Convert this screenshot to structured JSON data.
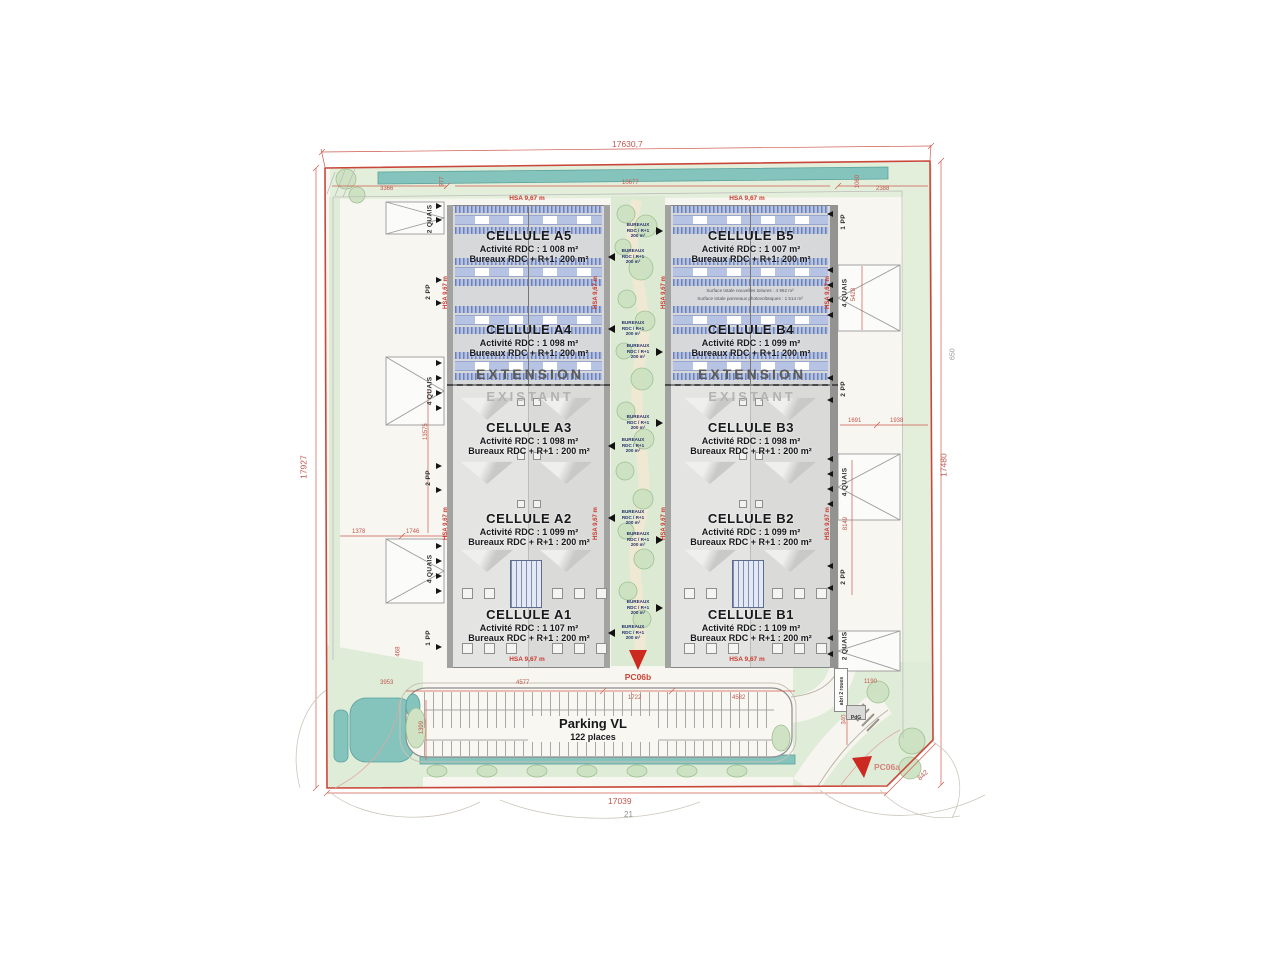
{
  "page": {
    "number": "21"
  },
  "dims": [
    "17630,7",
    "17927",
    "17480",
    "17039",
    "842",
    "650",
    "3366",
    "977",
    "10677",
    "1060",
    "2388",
    "13575",
    "1378",
    "1746",
    "5428",
    "1691",
    "1938",
    "8149",
    "468",
    "3953",
    "4577",
    "1722",
    "4582",
    "1399",
    "1190",
    "340"
  ],
  "labels": {
    "hsa": "HSA 9,67 m",
    "extension": "EXTENSION",
    "existant": "EXISTANT"
  },
  "cells": [
    {
      "id": "A5",
      "title": "CELLULE A5",
      "activite": "Activité RDC : 1 008 m²",
      "bureaux": "Bureaux RDC + R+1: 200 m²"
    },
    {
      "id": "A4",
      "title": "CELLULE A4",
      "activite": "Activité RDC : 1 098 m²",
      "bureaux": "Bureaux RDC + R+1: 200 m²"
    },
    {
      "id": "A3",
      "title": "CELLULE A3",
      "activite": "Activité RDC : 1 098 m²",
      "bureaux": "Bureaux RDC + R+1 : 200 m²"
    },
    {
      "id": "A2",
      "title": "CELLULE A2",
      "activite": "Activité RDC : 1 099 m²",
      "bureaux": "Bureaux RDC + R+1 : 200 m²"
    },
    {
      "id": "A1",
      "title": "CELLULE A1",
      "activite": "Activité RDC : 1 107 m²",
      "bureaux": "Bureaux RDC + R+1 : 200 m²"
    },
    {
      "id": "B5",
      "title": "CELLULE B5",
      "activite": "Activité RDC : 1 007 m²",
      "bureaux": "Bureaux RDC + R+1: 200 m²"
    },
    {
      "id": "B4",
      "title": "CELLULE B4",
      "activite": "Activité RDC : 1 099 m²",
      "bureaux": "Bureaux RDC + R+1: 200 m²"
    },
    {
      "id": "B3",
      "title": "CELLULE B3",
      "activite": "Activité RDC : 1 098 m²",
      "bureaux": "Bureaux RDC + R+1 : 200 m²"
    },
    {
      "id": "B2",
      "title": "CELLULE B2",
      "activite": "Activité RDC : 1 099 m²",
      "bureaux": "Bureaux RDC + R+1 : 200 m²"
    },
    {
      "id": "B1",
      "title": "CELLULE B1",
      "activite": "Activité RDC : 1 109 m²",
      "bureaux": "Bureaux RDC + R+1 : 200 m²"
    }
  ],
  "bureaux": {
    "l1": "BUREAUX",
    "l2": "RDC / R+1",
    "l3": "200 m²"
  },
  "docks_left": [
    "2 QUAIS",
    "2 PP",
    "4 QUAIS",
    "2 PP",
    "4 QUAIS",
    "1 PP"
  ],
  "docks_right": [
    "1 PP",
    "4 QUAIS",
    "2 PP",
    "4 QUAIS",
    "2 PP",
    "2 QUAIS"
  ],
  "parking": {
    "title": "Parking VL",
    "subtitle": "122 places"
  },
  "markers": {
    "pc06a": "PC06a",
    "pc06b": "PC06b"
  },
  "annex": {
    "abri": "abri 2 roues",
    "pdg": "PdG"
  },
  "notes": {
    "l1": "Surface totale nouvelles toitures : 4 962 m²",
    "l2": "Surface totale panneaux photovoltaïques : 1 514 m²"
  },
  "colors": {
    "boundary_red": "#c9473a",
    "dim_red": "#c2574b",
    "water_teal": "#85c3bd",
    "landscape_green": "#dcead4",
    "roof_blue": "#8fa3cc",
    "marker_red": "#cc2a20"
  }
}
